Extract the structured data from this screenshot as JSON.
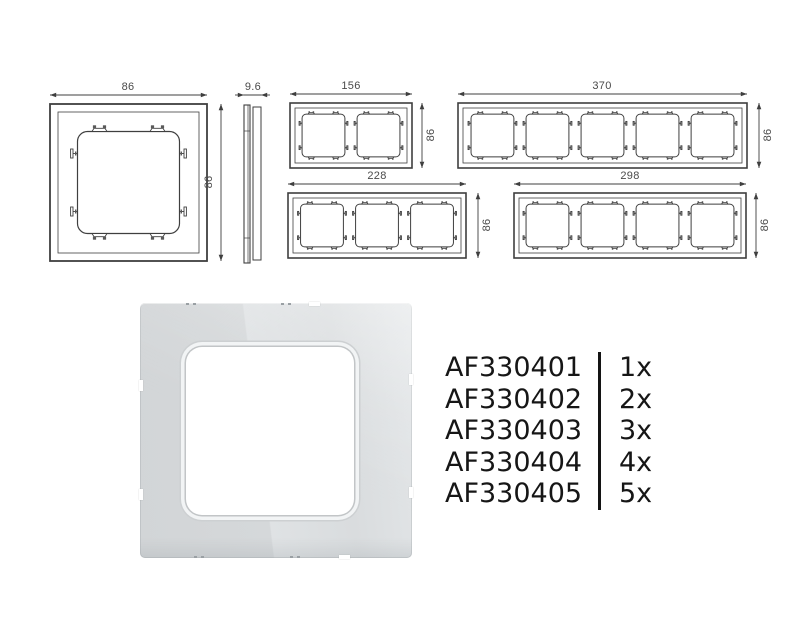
{
  "page": {
    "background": "#ffffff",
    "line_color": "#3f3f3f",
    "clip_color": "#5a5a5a",
    "dim_text_color": "#4a4a4a",
    "code_text_color": "#161616",
    "photo_gray": "#d6d9db"
  },
  "drawings": {
    "front_single": {
      "width_mm": "86",
      "height_mm": "86"
    },
    "side_profile": {
      "thickness_mm": "9.6"
    },
    "frame_2gang": {
      "width_mm": "156",
      "height_mm": "86"
    },
    "frame_5gang": {
      "width_mm": "370",
      "height_mm": "86"
    },
    "frame_3gang": {
      "width_mm": "228",
      "height_mm": "86"
    },
    "frame_4gang": {
      "width_mm": "298",
      "height_mm": "86"
    }
  },
  "products": {
    "items": [
      {
        "code": "AF330401",
        "qty": "1x"
      },
      {
        "code": "AF330402",
        "qty": "2x"
      },
      {
        "code": "AF330403",
        "qty": "3x"
      },
      {
        "code": "AF330404",
        "qty": "4x"
      },
      {
        "code": "AF330405",
        "qty": "5x"
      }
    ]
  }
}
